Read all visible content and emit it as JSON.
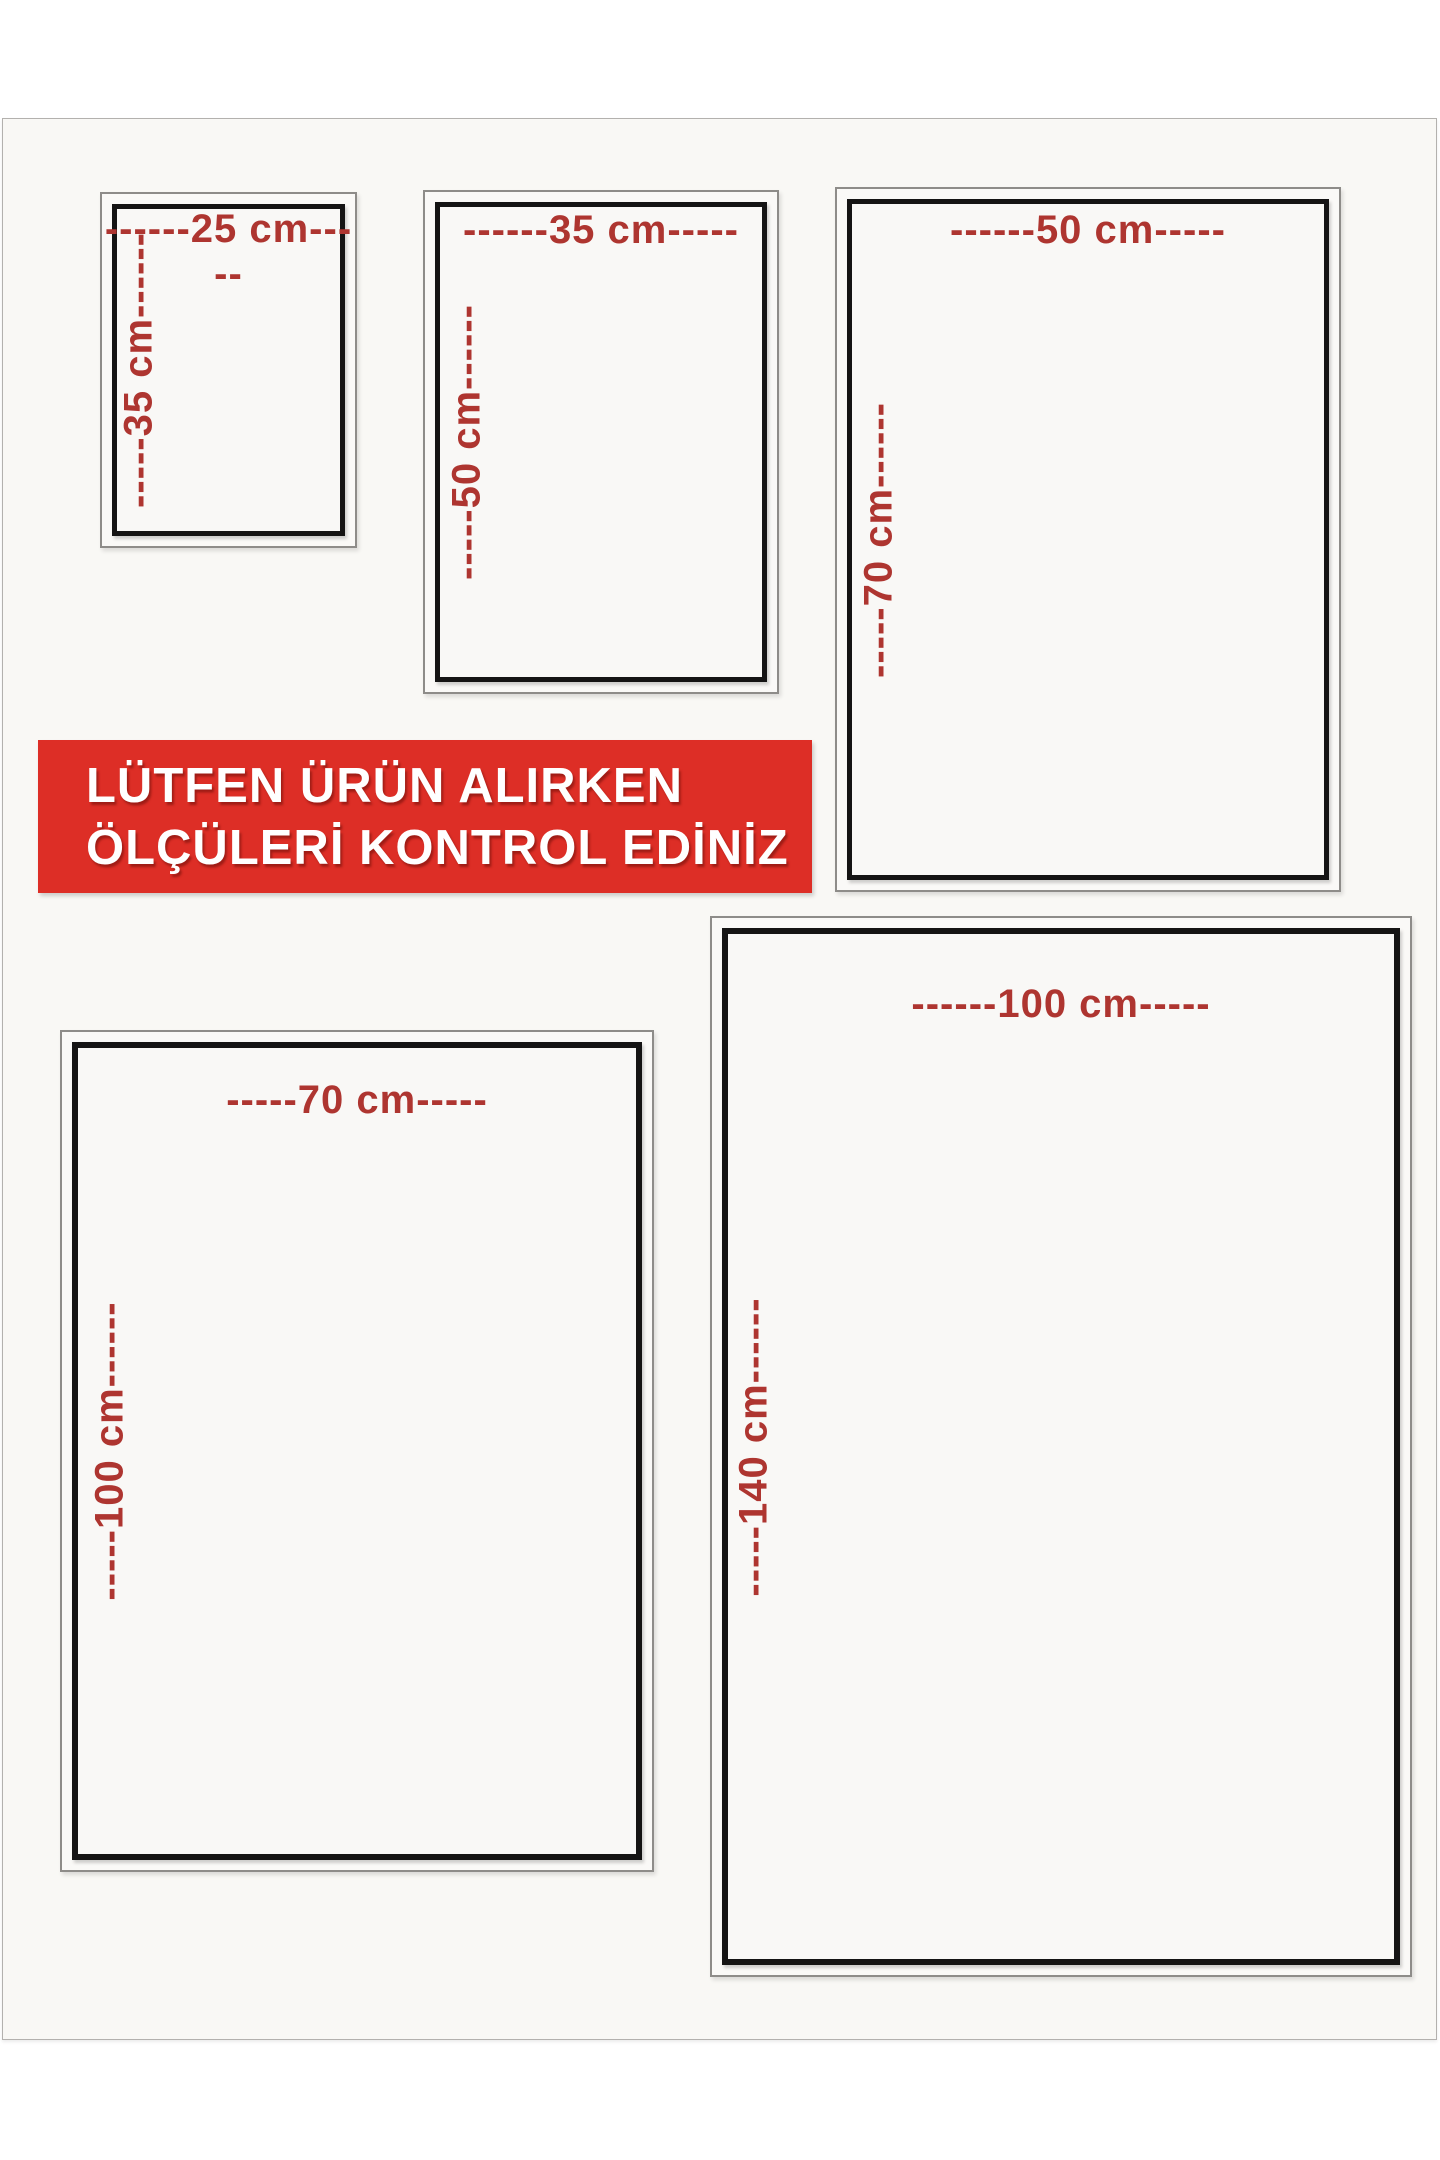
{
  "banner": {
    "line1": "LÜTFEN ÜRÜN ALIRKEN",
    "line2": "ÖLÇÜLERİ KONTROL EDİNİZ",
    "background_color": "#dd2e26",
    "text_color": "#ffffff"
  },
  "colors": {
    "dimension_label_red": "#ae3530",
    "inner_frame_black": "#151414",
    "outer_frame_gray": "#8e8c89",
    "sheet_background": "#f9f8f5"
  },
  "sizes": [
    {
      "id": "25x35",
      "width_cm": 25,
      "height_cm": 35,
      "width_label": "------25 cm-----",
      "height_label": "-----35 cm------"
    },
    {
      "id": "35x50",
      "width_cm": 35,
      "height_cm": 50,
      "width_label": "------35 cm-----",
      "height_label": "-----50 cm------"
    },
    {
      "id": "50x70",
      "width_cm": 50,
      "height_cm": 70,
      "width_label": "------50 cm-----",
      "height_label": "-----70 cm------"
    },
    {
      "id": "70x100",
      "width_cm": 70,
      "height_cm": 100,
      "width_label": "-----70 cm-----",
      "height_label": "-----100 cm------"
    },
    {
      "id": "100x140",
      "width_cm": 100,
      "height_cm": 140,
      "width_label": "------100 cm-----",
      "height_label": "-----140 cm------"
    }
  ]
}
